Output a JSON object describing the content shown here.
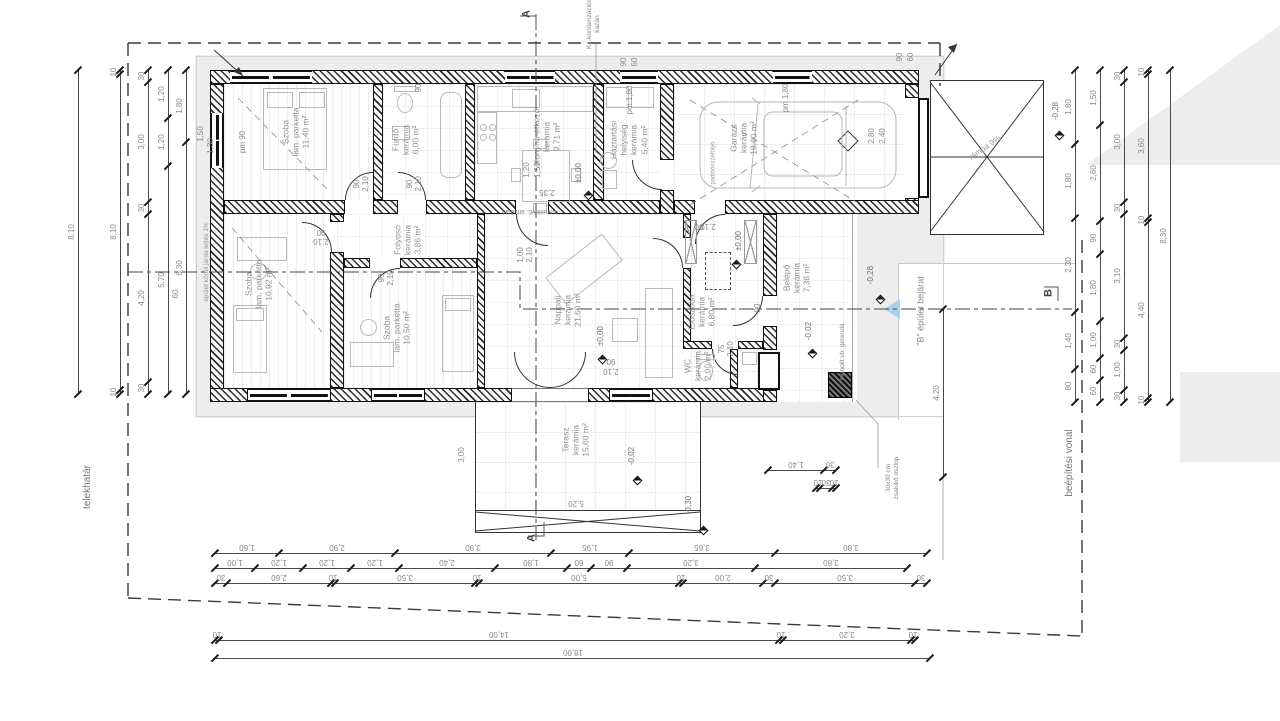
{
  "drawing": {
    "title": "családi ház alaprajz",
    "rooms": [
      {
        "lines": [
          "Szoba",
          "lam. parketta",
          "11,40 m²"
        ],
        "x": 296,
        "y": 132
      },
      {
        "lines": [
          "Fürdő",
          "kerámia",
          "6,00 m²"
        ],
        "x": 406,
        "y": 140
      },
      {
        "lines": [
          "Konyha-étkező",
          "kerámia",
          "9,71 m²"
        ],
        "x": 547,
        "y": 137
      },
      {
        "lines": [
          "Háztartási",
          "helyiség",
          "kerámia",
          "5,40 m²"
        ],
        "x": 629,
        "y": 140
      },
      {
        "lines": [
          "Garázs",
          "kerámia",
          "18,60 m²"
        ],
        "x": 744,
        "y": 138
      },
      {
        "lines": [
          "Szoba",
          "lam. parketta",
          "10,92 m²"
        ],
        "x": 259,
        "y": 284
      },
      {
        "lines": [
          "Szoba",
          "lam. parketta",
          "10,50 m²"
        ],
        "x": 397,
        "y": 328
      },
      {
        "lines": [
          "Folyosó",
          "kerámia",
          "3,86 m²"
        ],
        "x": 408,
        "y": 240
      },
      {
        "lines": [
          "Nappali",
          "kerámia",
          "21,60 m²"
        ],
        "x": 568,
        "y": 310
      },
      {
        "lines": [
          "Előszoba",
          "kerámia",
          "6,80 m²"
        ],
        "x": 702,
        "y": 312
      },
      {
        "lines": [
          "WC",
          "kerámia",
          "2,00 m²"
        ],
        "x": 698,
        "y": 366
      },
      {
        "lines": [
          "Belépő",
          "kerámia",
          "7,38 m²"
        ],
        "x": 797,
        "y": 278
      },
      {
        "lines": [
          "Terasz",
          "kerámia",
          "15,60 m²"
        ],
        "x": 576,
        "y": 440
      }
    ],
    "annotations": [
      {
        "lines": [
          "telekhatár"
        ],
        "x": 88,
        "y": 487,
        "r": -90,
        "s": 10,
        "c": "#777"
      },
      {
        "lines": [
          "épület körüli járda lejtés 1%"
        ],
        "x": 207,
        "y": 262,
        "r": -90,
        "s": 6.5,
        "c": "#9a9a9a"
      },
      {
        "lines": [
          "beépítési vonal"
        ],
        "x": 1070,
        "y": 463,
        "r": -90,
        "s": 10,
        "c": "#777"
      },
      {
        "lines": [
          "\"B\" épület bejárat"
        ],
        "x": 921,
        "y": 311,
        "r": -90,
        "s": 9,
        "c": "#8a8a8a"
      },
      {
        "lines": [
          "K1-kondenzációs",
          "kazán"
        ],
        "x": 594,
        "y": 24,
        "r": -90,
        "s": 6.5,
        "c": "#8a8a8a"
      },
      {
        "lines": [
          "monolit vb. gerenda"
        ],
        "x": 843,
        "y": 352,
        "r": -90,
        "s": 6.5,
        "c": "#8a8a8a"
      },
      {
        "lines": [
          "monolit vb. áthidaló"
        ],
        "x": 530,
        "y": 211,
        "r": 180,
        "s": 6.5,
        "c": "#8a8a8a"
      },
      {
        "lines": [
          "rámpa 9%"
        ],
        "x": 985,
        "y": 148,
        "r": -35,
        "s": 8,
        "c": "#9a9a9a"
      },
      {
        "lines": [
          "padlóösszefolyó"
        ],
        "x": 714,
        "y": 163,
        "r": -90,
        "s": 6,
        "c": "#9a9a9a"
      },
      {
        "lines": [
          "30x30 cm",
          "zsalukő oszlop"
        ],
        "x": 893,
        "y": 478,
        "r": -90,
        "s": 6.5,
        "c": "#8a8a8a"
      }
    ],
    "section_markers": [
      {
        "label": "A",
        "x": 527,
        "y": 14
      },
      {
        "label": "A",
        "x": 532,
        "y": 538
      },
      {
        "label": "B",
        "x": 1049,
        "y": 293
      }
    ],
    "elevations": [
      {
        "label": "±0,00",
        "lx": 579,
        "ly": 173,
        "dx": 585,
        "dy": 192
      },
      {
        "label": "±0,00",
        "lx": 601,
        "ly": 336,
        "dx": 599,
        "dy": 356
      },
      {
        "label": "±0,00",
        "lx": 739,
        "ly": 241,
        "dx": 733,
        "dy": 261
      },
      {
        "label": "-0,02",
        "lx": 632,
        "ly": 456,
        "dx": 634,
        "dy": 477
      },
      {
        "label": "-0,02",
        "lx": 809,
        "ly": 331,
        "dx": 809,
        "dy": 350
      },
      {
        "label": "-0,28",
        "lx": 871,
        "ly": 275,
        "dx": 877,
        "dy": 296
      },
      {
        "label": "-0,28",
        "lx": 1056,
        "ly": 111,
        "dx": 1056,
        "dy": 132
      },
      {
        "label": "-0,30",
        "lx": 689,
        "ly": 505,
        "dx": 700,
        "dy": 527
      }
    ],
    "small_dims": [
      {
        "t": "1,50",
        "x": 201,
        "y": 134,
        "r": -90
      },
      {
        "t": "1,30",
        "x": 211,
        "y": 146,
        "r": -90
      },
      {
        "t": "pm 90",
        "x": 243,
        "y": 142,
        "r": -90
      },
      {
        "t": "90",
        "x": 419,
        "y": 88,
        "r": -90
      },
      {
        "t": "1,20",
        "x": 527,
        "y": 170,
        "r": -90
      },
      {
        "t": "1,50",
        "x": 538,
        "y": 170,
        "r": -90
      },
      {
        "t": "90",
        "x": 624,
        "y": 62,
        "r": -90
      },
      {
        "t": "60",
        "x": 635,
        "y": 62,
        "r": -90
      },
      {
        "t": "pm 1,80",
        "x": 630,
        "y": 100,
        "r": -90
      },
      {
        "t": "pm 1,80",
        "x": 786,
        "y": 98,
        "r": -90
      },
      {
        "t": "90",
        "x": 900,
        "y": 57,
        "r": -90
      },
      {
        "t": "60",
        "x": 911,
        "y": 57,
        "r": -90
      },
      {
        "t": "2,80",
        "x": 872,
        "y": 136,
        "r": -90
      },
      {
        "t": "2,40",
        "x": 883,
        "y": 136,
        "r": -90
      },
      {
        "t": "90",
        "x": 357,
        "y": 184,
        "r": -90
      },
      {
        "t": "2,10",
        "x": 366,
        "y": 184,
        "r": -90
      },
      {
        "t": "90",
        "x": 410,
        "y": 184,
        "r": -90
      },
      {
        "t": "2,10",
        "x": 419,
        "y": 184,
        "r": -90
      },
      {
        "t": "90",
        "x": 321,
        "y": 232,
        "r": 180
      },
      {
        "t": "2,10",
        "x": 321,
        "y": 241,
        "r": 180
      },
      {
        "t": "90",
        "x": 382,
        "y": 278,
        "r": -90
      },
      {
        "t": "2,10",
        "x": 391,
        "y": 278,
        "r": -90
      },
      {
        "t": "1,00",
        "x": 521,
        "y": 255,
        "r": -90
      },
      {
        "t": "2,10",
        "x": 530,
        "y": 255,
        "r": -90
      },
      {
        "t": "75",
        "x": 722,
        "y": 349,
        "r": -90
      },
      {
        "t": "2,10",
        "x": 731,
        "y": 349,
        "r": -90
      },
      {
        "t": "90",
        "x": 758,
        "y": 308,
        "r": -90
      },
      {
        "t": "90",
        "x": 611,
        "y": 361,
        "r": 180
      },
      {
        "t": "2,10",
        "x": 611,
        "y": 371,
        "r": 180
      },
      {
        "t": "90",
        "x": 699,
        "y": 226,
        "r": 180
      },
      {
        "t": "2,10",
        "x": 708,
        "y": 226,
        "r": 180
      },
      {
        "t": "2,35",
        "x": 547,
        "y": 192,
        "r": 180
      },
      {
        "t": "3,00",
        "x": 462,
        "y": 455,
        "r": -90
      },
      {
        "t": "5,20",
        "x": 576,
        "y": 503,
        "r": 180
      },
      {
        "t": "60",
        "x": 176,
        "y": 294,
        "r": -90
      }
    ],
    "dim_chains": [
      {
        "o": "h",
        "f": 1,
        "x": 215,
        "y": 553,
        "segs": [
          [
            64,
            "1,60"
          ],
          [
            116,
            "2,90"
          ],
          [
            156,
            "3,90"
          ],
          [
            78,
            "1,95"
          ],
          [
            146,
            "3,65"
          ],
          [
            152,
            "3,80"
          ]
        ]
      },
      {
        "o": "h",
        "f": 1,
        "x": 215,
        "y": 568,
        "segs": [
          [
            40,
            "1,00"
          ],
          [
            48,
            "1,20"
          ],
          [
            48,
            "1,20"
          ],
          [
            48,
            "1,20"
          ],
          [
            96,
            "2,40"
          ],
          [
            72,
            "1,80"
          ],
          [
            24,
            "60"
          ],
          [
            36,
            "90"
          ],
          [
            128,
            "3,20"
          ],
          [
            152,
            "3,80"
          ]
        ]
      },
      {
        "o": "h",
        "f": 1,
        "x": 215,
        "y": 583,
        "segs": [
          [
            12,
            "30"
          ],
          [
            104,
            "2,60"
          ],
          [
            4,
            "10"
          ],
          [
            140,
            "3,50"
          ],
          [
            4,
            "10"
          ],
          [
            200,
            "5,00"
          ],
          [
            4,
            "10"
          ],
          [
            80,
            "2,00"
          ],
          [
            12,
            "30"
          ],
          [
            140,
            "3,50"
          ],
          [
            12,
            "30"
          ]
        ]
      },
      {
        "o": "h",
        "f": 1,
        "x": 215,
        "y": 640,
        "segs": [
          [
            4,
            "10"
          ],
          [
            560,
            "14,00"
          ],
          [
            4,
            "10"
          ],
          [
            128,
            "3,20"
          ],
          [
            4,
            "10"
          ]
        ]
      },
      {
        "o": "h",
        "f": 1,
        "x": 215,
        "y": 658,
        "segs": [
          [
            715,
            "18,00"
          ]
        ]
      },
      {
        "o": "h",
        "f": 1,
        "x": 768,
        "y": 470,
        "segs": [
          [
            56,
            "1,40"
          ],
          [
            12,
            "30"
          ]
        ]
      },
      {
        "o": "h",
        "f": 1,
        "x": 816,
        "y": 488,
        "segs": [
          [
            4,
            "10"
          ],
          [
            12,
            "30"
          ],
          [
            4,
            "10"
          ]
        ]
      },
      {
        "o": "v",
        "x": 78,
        "y": 70,
        "segs": [
          [
            324,
            "8,10"
          ]
        ]
      },
      {
        "o": "v",
        "x": 120,
        "y": 70,
        "segs": [
          [
            4,
            "10"
          ],
          [
            316,
            "8,10"
          ],
          [
            4,
            "10"
          ]
        ]
      },
      {
        "o": "v",
        "x": 148,
        "y": 70,
        "segs": [
          [
            12,
            "30"
          ],
          [
            120,
            "3,00"
          ],
          [
            12,
            "30"
          ],
          [
            168,
            "4,20"
          ],
          [
            12,
            "30"
          ]
        ]
      },
      {
        "o": "v",
        "x": 168,
        "y": 70,
        "segs": [
          [
            48,
            "1,20"
          ],
          [
            48,
            "1,20"
          ],
          [
            228,
            "5,70"
          ]
        ]
      },
      {
        "o": "v",
        "x": 186,
        "y": 70,
        "segs": [
          [
            72,
            "1,80"
          ],
          [
            252,
            "6,30"
          ]
        ]
      },
      {
        "o": "v",
        "x": 1075,
        "y": 70,
        "segs": [
          [
            74,
            "1,80"
          ],
          [
            74,
            "1,80"
          ],
          [
            94,
            "2,30"
          ],
          [
            57,
            "1,40"
          ],
          [
            33,
            "80"
          ]
        ]
      },
      {
        "o": "v",
        "x": 1100,
        "y": 70,
        "segs": [
          [
            55,
            "1,50"
          ],
          [
            96,
            "2,60"
          ],
          [
            33,
            "90"
          ],
          [
            67,
            "1,80"
          ],
          [
            37,
            "1,00"
          ],
          [
            22,
            "60"
          ],
          [
            22,
            "60"
          ]
        ]
      },
      {
        "o": "v",
        "x": 1124,
        "y": 70,
        "segs": [
          [
            12,
            "30"
          ],
          [
            120,
            "3,00"
          ],
          [
            12,
            "30"
          ],
          [
            124,
            "3,10"
          ],
          [
            12,
            "30"
          ],
          [
            40,
            "1,00"
          ],
          [
            12,
            "30"
          ]
        ]
      },
      {
        "o": "v",
        "x": 1148,
        "y": 70,
        "segs": [
          [
            4,
            "10"
          ],
          [
            144,
            "3,60"
          ],
          [
            4,
            "10"
          ],
          [
            176,
            "4,40"
          ],
          [
            4,
            "10"
          ]
        ]
      },
      {
        "o": "v",
        "x": 1170,
        "y": 70,
        "segs": [
          [
            332,
            "8,30"
          ]
        ]
      },
      {
        "o": "v",
        "x": 943,
        "y": 309,
        "segs": [
          [
            168,
            "4,20"
          ]
        ]
      }
    ]
  }
}
